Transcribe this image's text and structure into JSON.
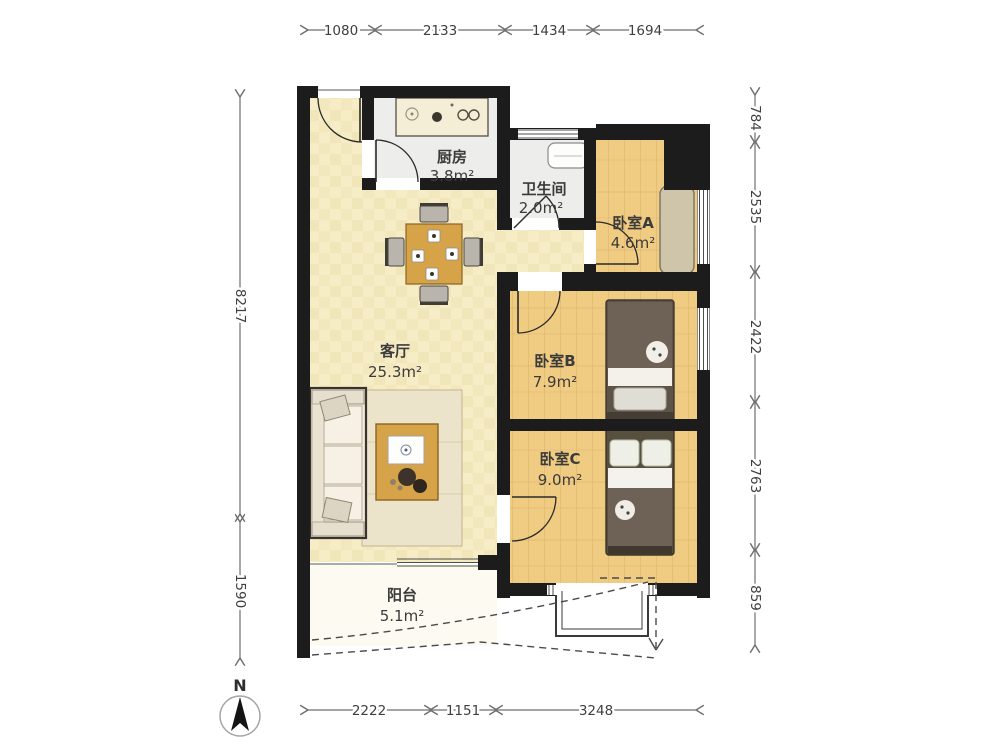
{
  "plan": {
    "type": "apartment-floor-plan",
    "rooms": {
      "kitchen": {
        "name": "厨房",
        "area": "3.8m²"
      },
      "bathroom": {
        "name": "卫生间",
        "area": "2.0m²"
      },
      "bedroomA": {
        "name": "卧室A",
        "area": "4.6m²"
      },
      "living": {
        "name": "客厅",
        "area": "25.3m²"
      },
      "bedroomB": {
        "name": "卧室B",
        "area": "7.9m²"
      },
      "bedroomC": {
        "name": "卧室C",
        "area": "9.0m²"
      },
      "balcony": {
        "name": "阳台",
        "area": "5.1m²"
      }
    },
    "dimensions": {
      "top": [
        "1080",
        "2133",
        "1434",
        "1694"
      ],
      "bottom": [
        "2222",
        "1151",
        "3248"
      ],
      "left": [
        "8217",
        "1590"
      ],
      "right": [
        "784",
        "2535",
        "2422",
        "2763",
        "859"
      ]
    },
    "compass": {
      "north_label": "N"
    },
    "colors": {
      "wall": "#1c1c1c",
      "living_floor": "#f6ecc6",
      "wood_floor": "#f0cb82",
      "tile_floor": "#ededeb",
      "balcony_floor": "#fcfaf1",
      "furniture_wood": "#d7a348",
      "bed_duvet": "#6e6257",
      "label_text": "#3b3b3b",
      "dimension_text": "#3f3f3f"
    }
  }
}
